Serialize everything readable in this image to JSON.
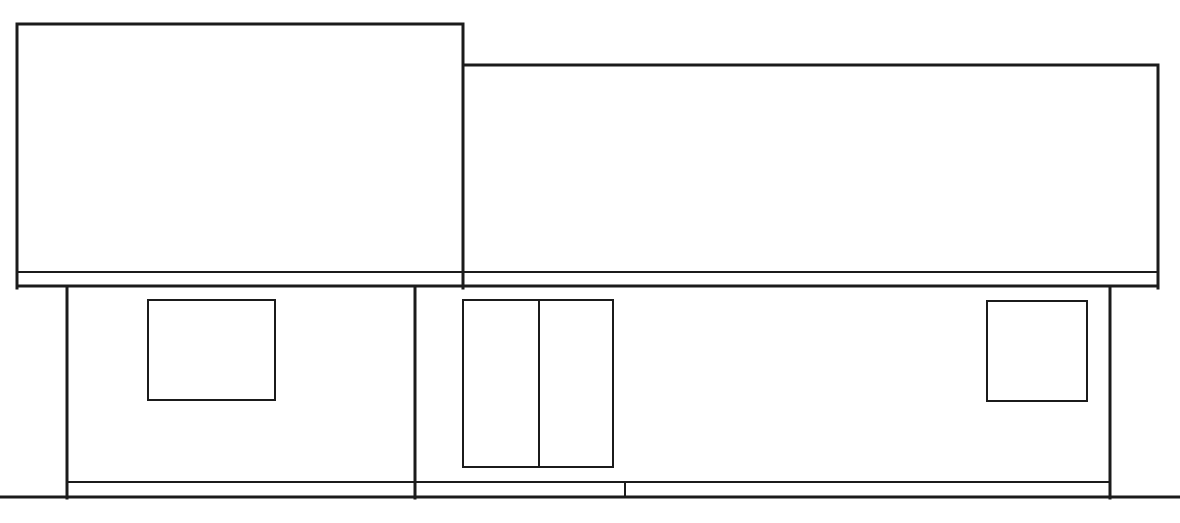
{
  "drawing": {
    "kind": "architectural-elevation",
    "canvas": {
      "width": 1180,
      "height": 523
    },
    "colors": {
      "background": "#ffffff",
      "line": "#1b1b1b"
    },
    "segments": [
      {
        "name": "left-roof-top-edge",
        "x1": 17,
        "y1": 24,
        "x2": 463,
        "y2": 24,
        "w": 3
      },
      {
        "name": "left-roof-left-edge",
        "x1": 17,
        "y1": 24,
        "x2": 17,
        "y2": 288,
        "w": 3
      },
      {
        "name": "roof-junction-edge",
        "x1": 463,
        "y1": 24,
        "x2": 463,
        "y2": 288,
        "w": 3
      },
      {
        "name": "right-roof-top-edge",
        "x1": 463,
        "y1": 65,
        "x2": 1158,
        "y2": 65,
        "w": 3
      },
      {
        "name": "right-roof-right-edge",
        "x1": 1158,
        "y1": 65,
        "x2": 1158,
        "y2": 288,
        "w": 3
      },
      {
        "name": "fascia-upper-line",
        "x1": 17,
        "y1": 272,
        "x2": 1158,
        "y2": 272,
        "w": 2
      },
      {
        "name": "fascia-lower-line",
        "x1": 17,
        "y1": 286,
        "x2": 1158,
        "y2": 286,
        "w": 3
      },
      {
        "name": "wall-left-edge",
        "x1": 67,
        "y1": 288,
        "x2": 67,
        "y2": 498,
        "w": 3
      },
      {
        "name": "wall-center-divider",
        "x1": 415,
        "y1": 288,
        "x2": 415,
        "y2": 498,
        "w": 3
      },
      {
        "name": "wall-right-edge",
        "x1": 1110,
        "y1": 288,
        "x2": 1110,
        "y2": 498,
        "w": 3
      },
      {
        "name": "foundation-line",
        "x1": 67,
        "y1": 482,
        "x2": 1110,
        "y2": 482,
        "w": 2
      },
      {
        "name": "foundation-joint",
        "x1": 625,
        "y1": 482,
        "x2": 625,
        "y2": 497,
        "w": 2
      },
      {
        "name": "ground-line",
        "x1": 0,
        "y1": 497,
        "x2": 1180,
        "y2": 497,
        "w": 3
      },
      {
        "name": "door-center-mullion",
        "x1": 539,
        "y1": 301,
        "x2": 539,
        "y2": 466,
        "w": 2
      }
    ],
    "openings": [
      {
        "name": "left-window",
        "x": 148,
        "y": 300,
        "w": 127,
        "h": 100,
        "stroke": 2
      },
      {
        "name": "sliding-glass-door",
        "x": 463,
        "y": 300,
        "w": 150,
        "h": 167,
        "stroke": 2
      },
      {
        "name": "right-window",
        "x": 987,
        "y": 301,
        "w": 100,
        "h": 100,
        "stroke": 2
      }
    ]
  }
}
